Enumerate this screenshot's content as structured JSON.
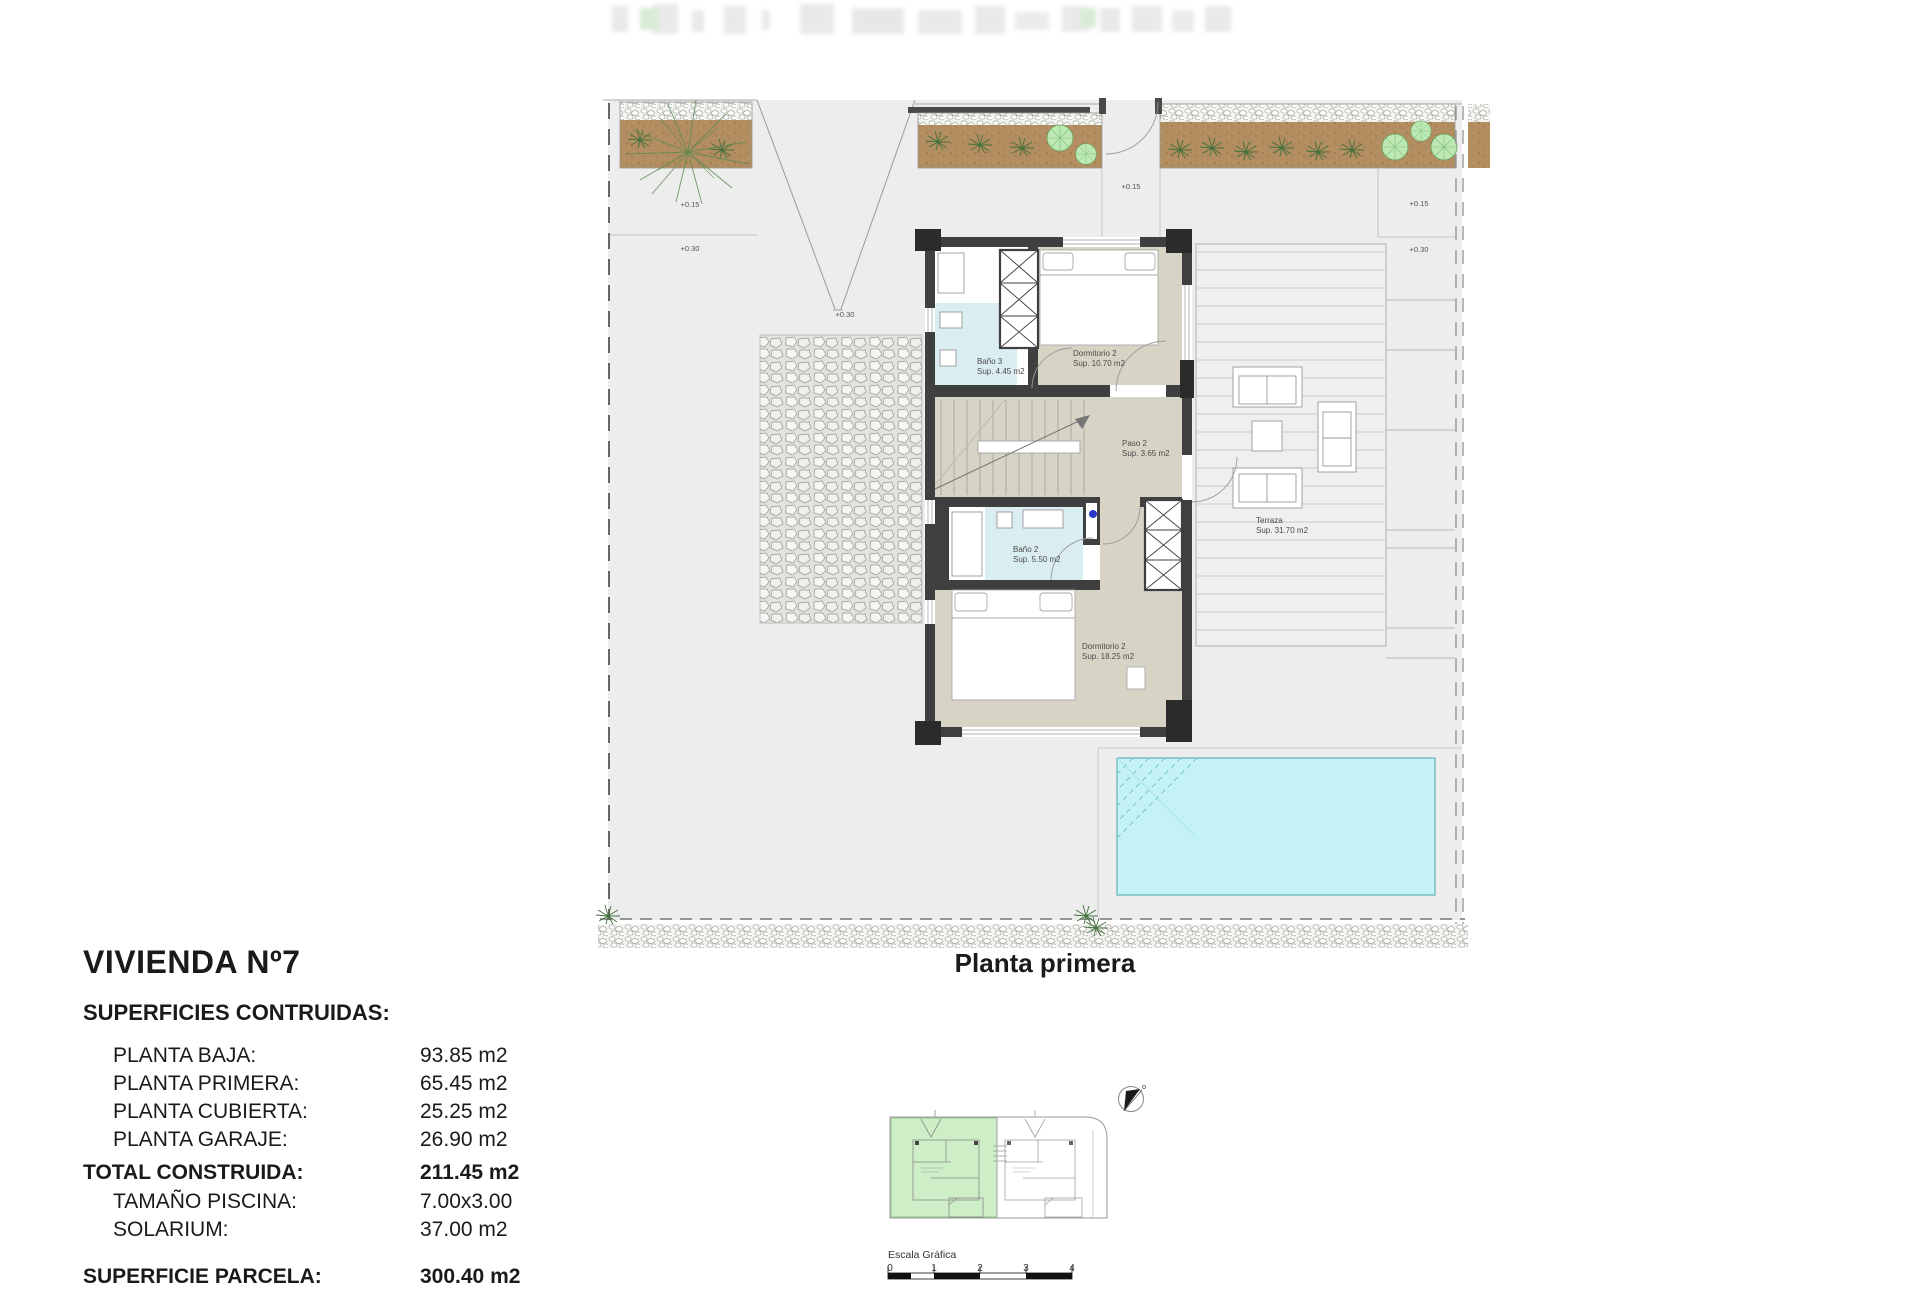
{
  "plan": {
    "caption": "Planta primera",
    "rooms": [
      {
        "name": "Baño 3",
        "area": "Sup. 4.45 m2"
      },
      {
        "name": "Dormitorio 2",
        "area": "Sup. 10.70 m2"
      },
      {
        "name": "Paso 2",
        "area": "Sup. 3.65 m2"
      },
      {
        "name": "Baño 2",
        "area": "Sup. 5.50 m2"
      },
      {
        "name": "Dormitorio 2",
        "area": "Sup. 18.25 m2"
      },
      {
        "name": "Terraza",
        "area": "Sup. 31.70 m2"
      }
    ],
    "levels": {
      "left_upper": "+0.15",
      "left_lower": "+0.30",
      "driveway": "+0.30",
      "entry": "+0.15",
      "right_upper": "+0.15",
      "right_lower": "+0.30"
    }
  },
  "title_block": {
    "title": "VIVIENDA Nº7",
    "subtitle": "SUPERFICIES CONTRUIDAS:",
    "rows": [
      {
        "label": "PLANTA BAJA:",
        "value": "93.85 m2"
      },
      {
        "label": "PLANTA PRIMERA:",
        "value": "65.45 m2"
      },
      {
        "label": "PLANTA CUBIERTA:",
        "value": "25.25 m2"
      },
      {
        "label": "PLANTA GARAJE:",
        "value": "26.90 m2"
      },
      {
        "label": "TOTAL CONSTRUIDA:",
        "value": "211.45 m2"
      },
      {
        "label": "TAMAÑO PISCINA:",
        "value": "7.00x3.00"
      },
      {
        "label": "SOLARIUM:",
        "value": "37.00 m2"
      },
      {
        "label": "SUPERFICIE PARCELA:",
        "value": "300.40 m2"
      }
    ]
  },
  "key_plan": {
    "scale_label": "Escala Gráfica",
    "ticks": [
      "0",
      "1",
      "2",
      "3",
      "4"
    ]
  },
  "colors": {
    "wall": "#3f3f3f",
    "room_beige": "#d8d4c5",
    "bath_blue": "#daeef1",
    "pool": "#c4f2f7",
    "soil": "#b28d60",
    "tree": "#bce8b4",
    "key_green": "#cdeec6",
    "plot_gray": "#ecedec"
  }
}
